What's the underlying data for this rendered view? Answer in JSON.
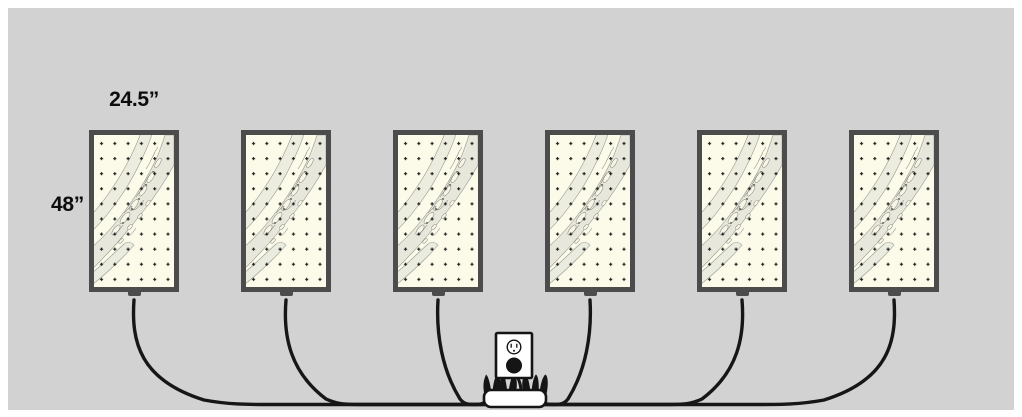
{
  "diagram": {
    "labels": {
      "panel_width": "24.5”",
      "panel_height": "48”"
    },
    "wall": {
      "color": "#d2d2d2",
      "margin_color": "#ffffff"
    },
    "panels": {
      "count": 6,
      "frame_color": "#4c4c4c",
      "paper_color": "#fcfbe9",
      "content": "river-chart map print with dot grid"
    },
    "cables": {
      "count": 6,
      "color": "#161616"
    },
    "outlet": {
      "kind": "wall-outlet",
      "plug_inserted": true,
      "face_color": "#ffffff"
    },
    "power_strip": {
      "body_color": "#ffffff",
      "plug_count": 7
    }
  }
}
